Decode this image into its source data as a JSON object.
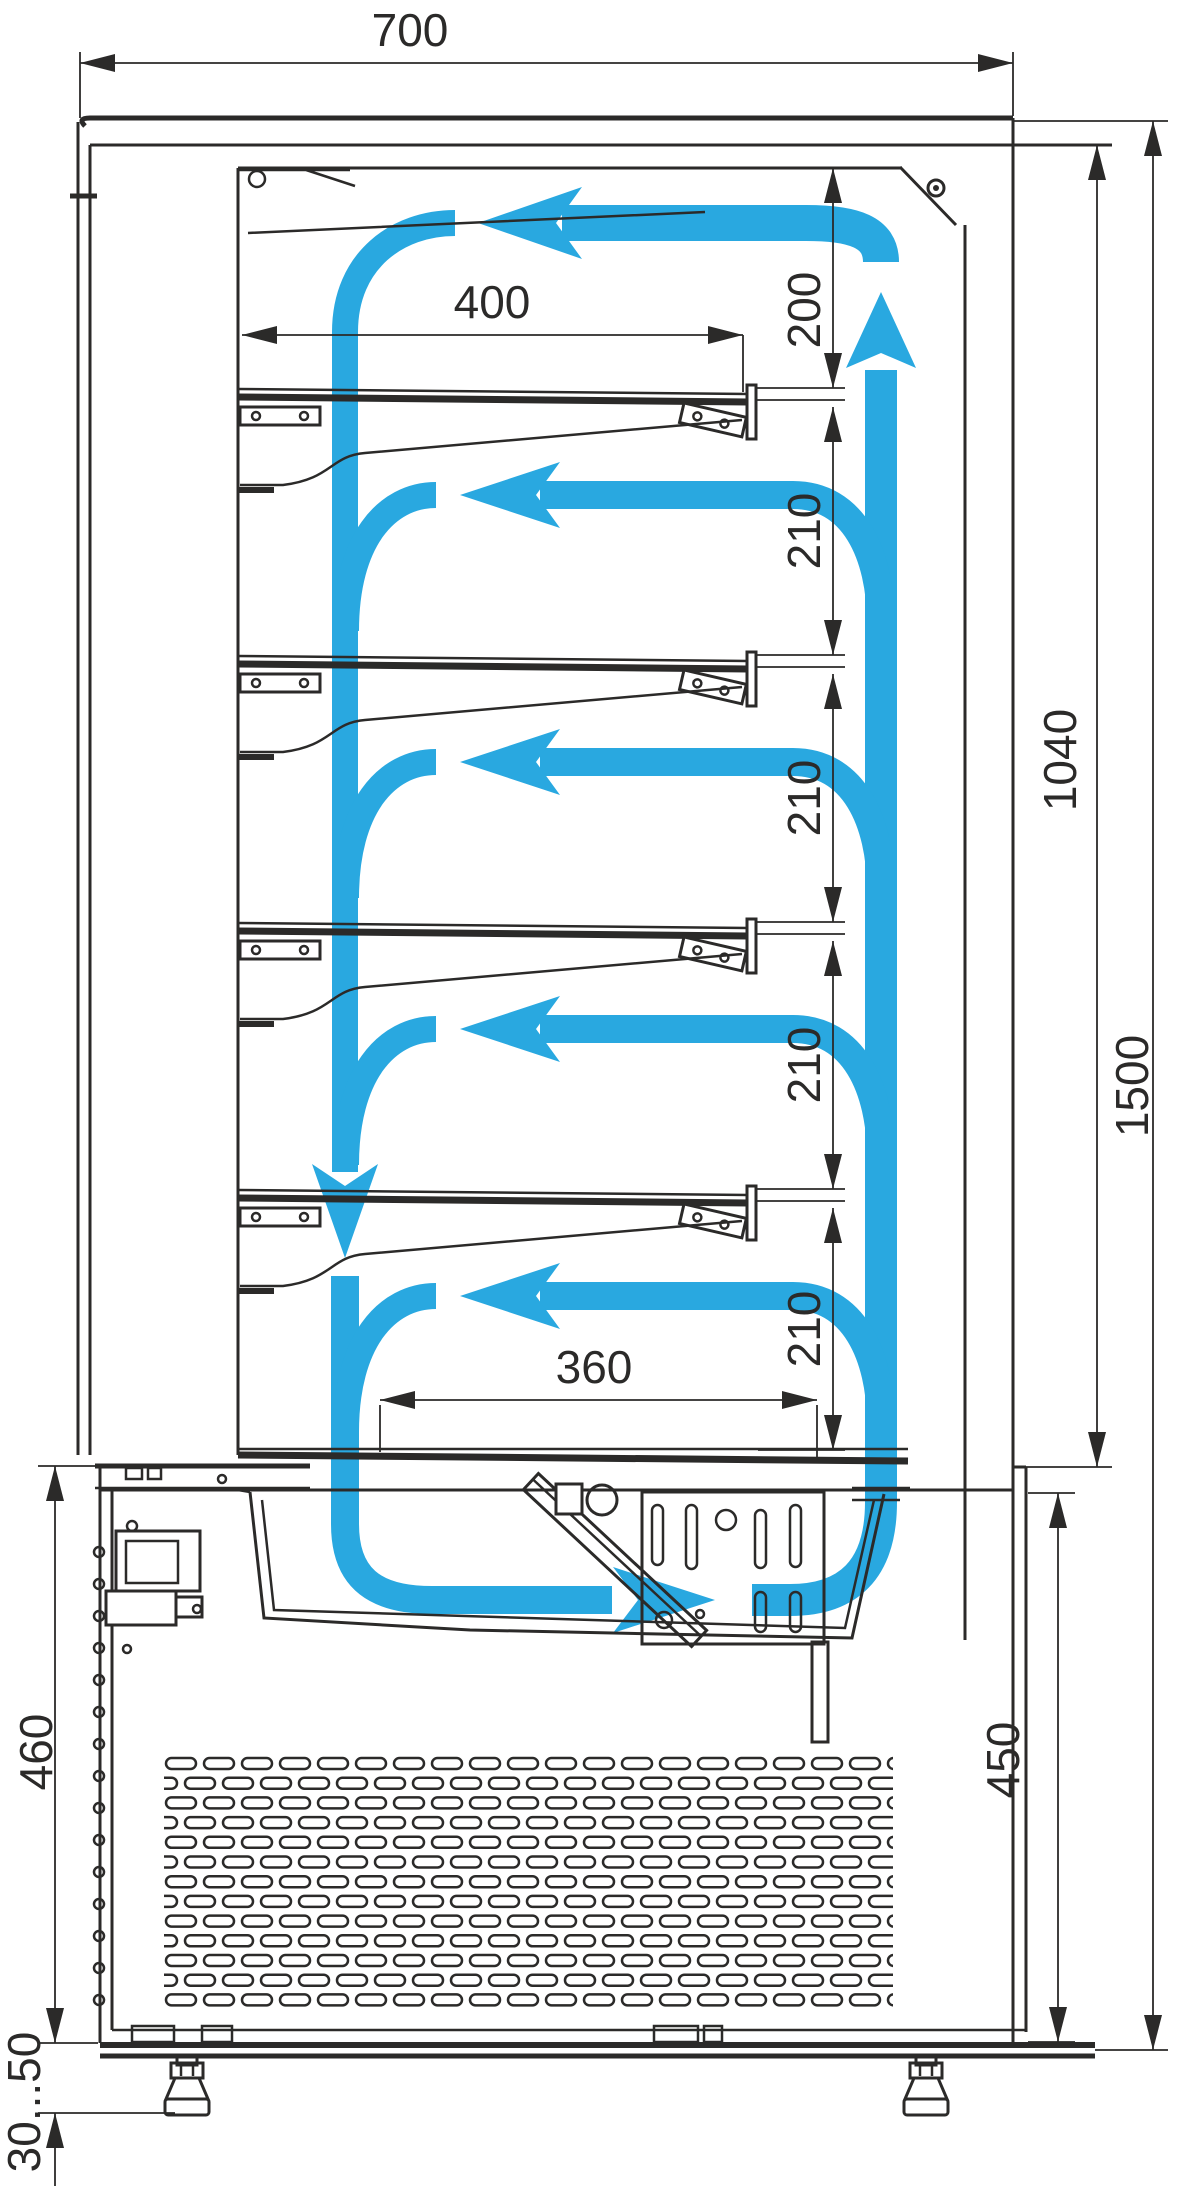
{
  "colors": {
    "accent": "#29a8e0",
    "line": "#2b2a29"
  },
  "dims": {
    "width": "700",
    "shelf_length": "400",
    "top_gap": "200",
    "gap1": "210",
    "gap2": "210",
    "gap3": "210",
    "gap4": "210",
    "inner_height": "1040",
    "total_height": "1500",
    "deck_length": "360",
    "compartment_height_left": "460",
    "compartment_height_right": "450",
    "foot_adjustment": "30...50"
  }
}
